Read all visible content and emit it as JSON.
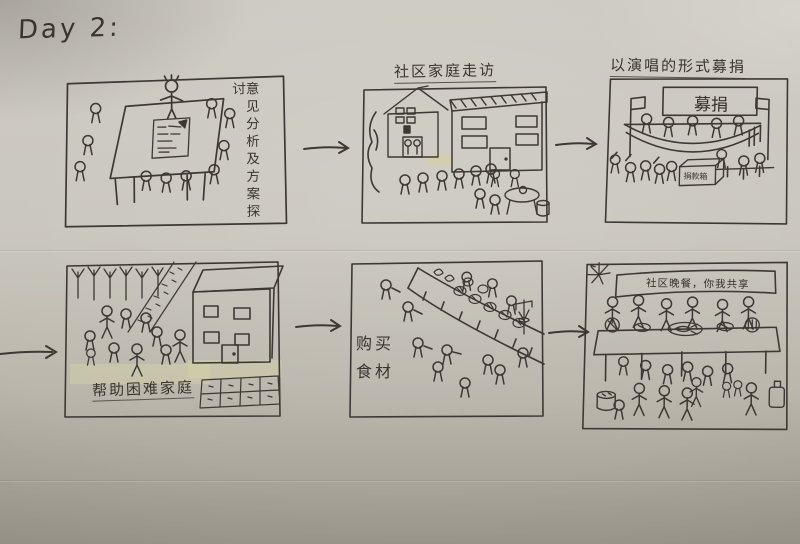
{
  "day_label": "Day 2:",
  "colors": {
    "paper": "#c9c6bd",
    "ink": "#3d3833",
    "patch": "#d8d4a0"
  },
  "panels": [
    {
      "id": "meeting-discussion",
      "caption": "意见分析及方案探讨"
    },
    {
      "id": "family-visits",
      "caption": "社区家庭走访"
    },
    {
      "id": "singing-fundraiser",
      "caption": "以演唱的形式募捐",
      "stage_banner": "募捐",
      "donation_box_label": "捐款箱"
    },
    {
      "id": "help-needy-families",
      "caption": "帮助困难家庭"
    },
    {
      "id": "buy-ingredients",
      "caption_line1": "购买",
      "caption_line2": "食材"
    },
    {
      "id": "community-dinner",
      "banner": "社区晚餐，你我共享"
    }
  ],
  "arrows": [
    {
      "from": "meeting-discussion",
      "to": "family-visits"
    },
    {
      "from": "family-visits",
      "to": "singing-fundraiser"
    },
    {
      "from": "page-edge",
      "to": "help-needy-families"
    },
    {
      "from": "help-needy-families",
      "to": "buy-ingredients"
    },
    {
      "from": "buy-ingredients",
      "to": "community-dinner"
    }
  ]
}
